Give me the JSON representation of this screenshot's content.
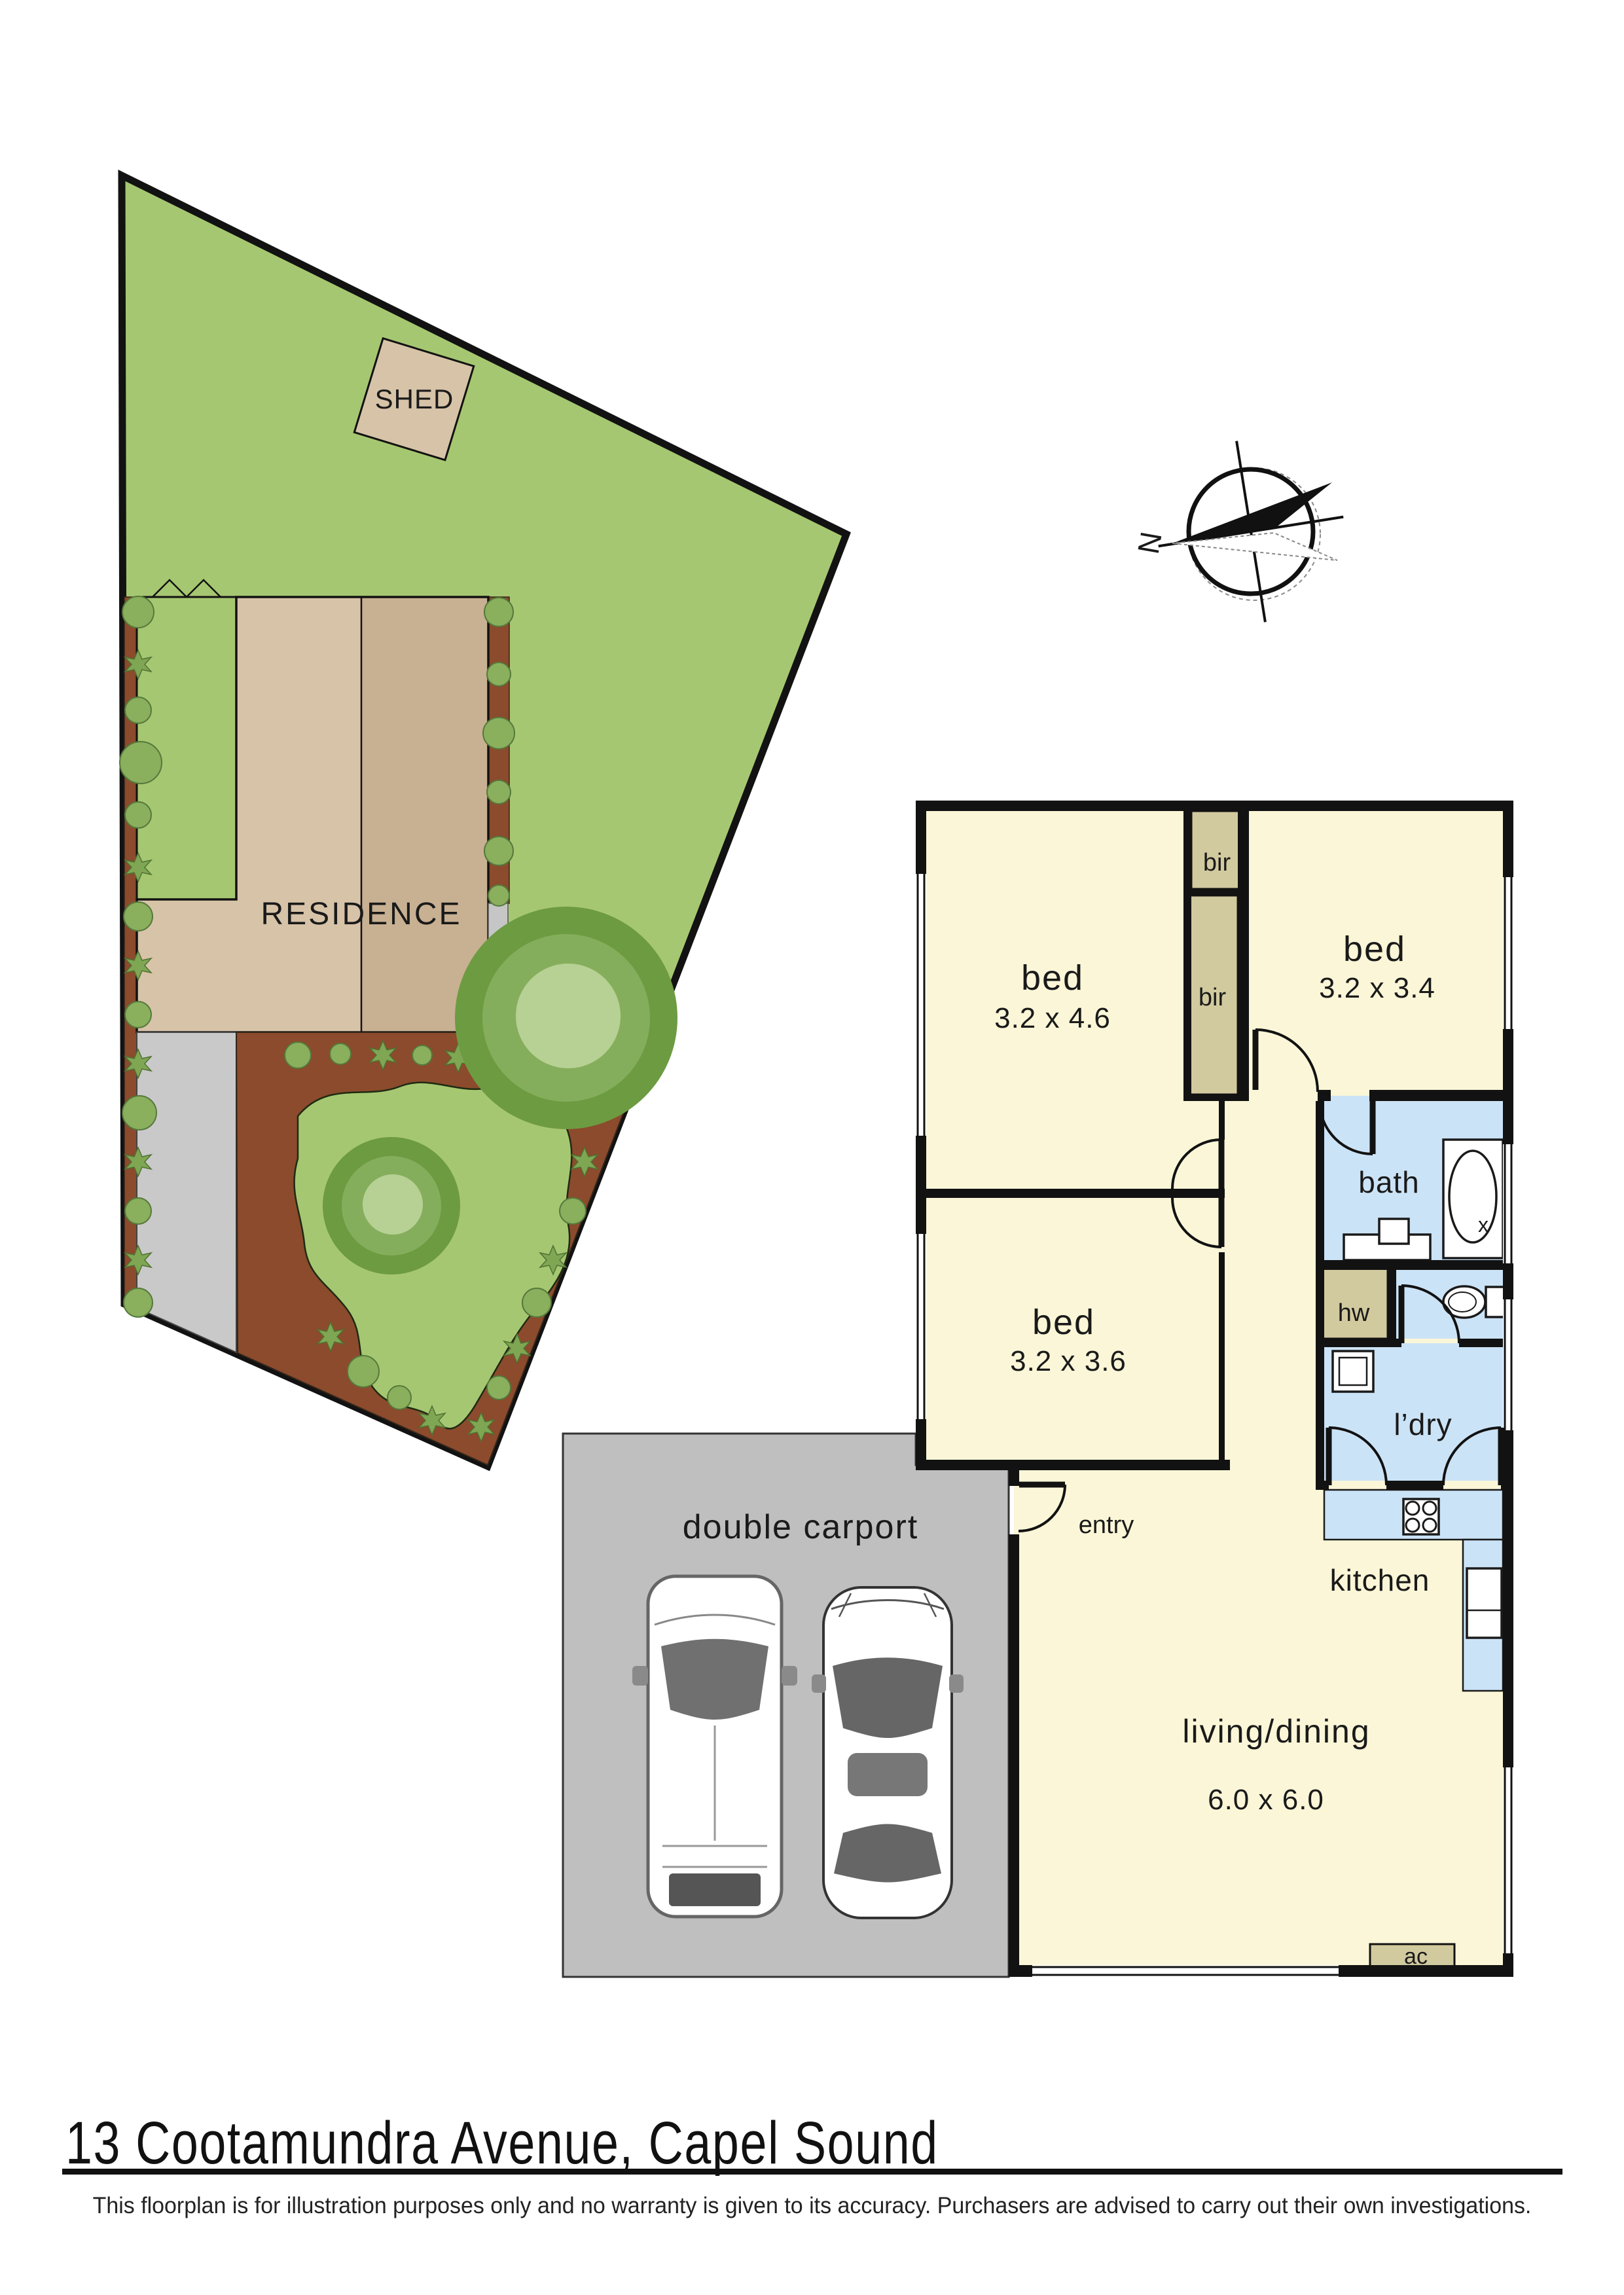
{
  "footer": {
    "address": "13 Cootamundra Avenue, Capel Sound",
    "disclaimer": "This floorplan is for illustration purposes only and no warranty is given to its accuracy. Purchasers are advised to carry out their own investigations."
  },
  "site_plan": {
    "shed_label": "SHED",
    "residence_label": "RESIDENCE"
  },
  "compass": {
    "north_label": "N"
  },
  "floorplan": {
    "bed1": {
      "label": "bed",
      "dims": "3.2 x 4.6"
    },
    "bed2": {
      "label": "bed",
      "dims": "3.2 x 3.4"
    },
    "bed3": {
      "label": "bed",
      "dims": "3.2 x 3.6"
    },
    "bath": {
      "label": "bath"
    },
    "laundry": {
      "label": "l’dry"
    },
    "kitchen": {
      "label": "kitchen"
    },
    "living": {
      "label": "living/dining",
      "dims": "6.0 x 6.0"
    },
    "entry": {
      "label": "entry"
    },
    "carport": {
      "label": "double carport"
    },
    "robe1": {
      "label": "bir"
    },
    "robe2": {
      "label": "bir"
    },
    "hot_water": {
      "label": "hw"
    },
    "air_con": {
      "label": "ac"
    },
    "bath_cross": {
      "label": "x"
    }
  },
  "colors": {
    "grass": "#A6C771",
    "garden_bed": "#8B4B2C",
    "roof_light": "#D7C3A8",
    "roof_dark": "#C8B092",
    "driveway": "#C9C9C9",
    "carport": "#BFBFBF",
    "room_cream": "#FAF6D7",
    "wet_blue": "#CBE3F7",
    "joinery_khaki": "#D2CA9F",
    "wall_black": "#121212"
  }
}
